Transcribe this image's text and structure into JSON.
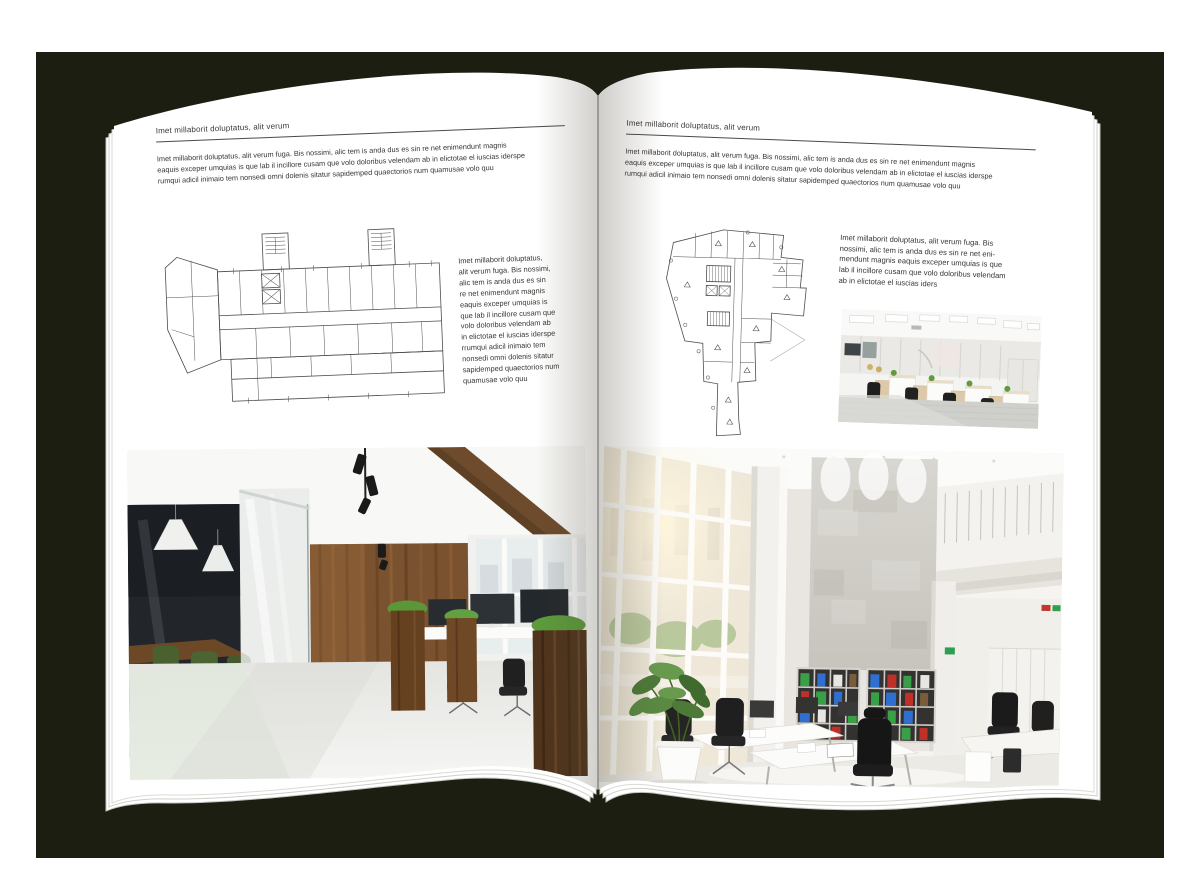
{
  "colors": {
    "backdrop": "#1c1e12",
    "paper": "#ffffff",
    "ink": "#33312e",
    "rule": "#4c4a47",
    "plan_line": "#4e4e4e",
    "binder_green": "#3aa048",
    "binder_blue": "#2f6fd0",
    "binder_red": "#c03028"
  },
  "left_page": {
    "kicker": "Imet millaborit doluptatus, alit verum",
    "intro": "Imet millaborit doluptatus, alit verum fuga. Bis nossimi, alic tem is anda dus es sin re net enimendunt magnis\neaquis exceper umquias is que lab il incillore cusam que volo doloribus velendam ab in elictotae el iuscias iderspe\nrumqui adicil inimaio tem nonsedi omni dolenis sitatur sapidemped quaectorios num quamusae volo quu",
    "side_note": "Imet millaborit doluptatus,\nalit verum fuga. Bis nossimi,\nalic tem is anda dus es sin\nre net enimendunt magnis\neaquis exceper umquias is\nque lab il incillore cusam que\nvolo doloribus velendam ab\nin elictotae el iuscias iderspe\nrrumqui adicil inimaio tem\nnonsedi omni dolenis sitatur\nsapidemped quaectorios num\nquamusae volo quu",
    "figures": {
      "floor_plan": "architectural-floor-plan-long-building-two-stair-towers",
      "photo": "office-interior-glass-meeting-room-wood-wall"
    }
  },
  "right_page": {
    "kicker": "Imet millaborit doluptatus, alit verum",
    "intro": "Imet millaborit doluptatus, alit verum fuga. Bis nossimi, alic tem is anda dus es sin re net enimendunt magnis\neaquis exceper umquias is que lab il incillore cusam que volo doloribus velendam ab in elictotae el iuscias iderspe\nrumqui adicil inimaio tem nonsedi omni dolenis sitatur sapidemped quaectorios num quamusae volo quu",
    "side_note": "Imet millaborit doluptatus, alit verum fuga. Bis\nnossimi, alic tem is anda dus es sin re net eni-\nmendunt magnis eaquis exceper umquias is que\nlab il incillore cusam que volo doloribus velendam\nab in elictotae el iuscias iders",
    "figures": {
      "floor_plan": "architectural-floor-plan-irregular-tower-footprint",
      "photo_small": "open-plan-office-cubicles-white-wood",
      "photo_large": "double-height-white-office-bookshelf-binders"
    }
  }
}
